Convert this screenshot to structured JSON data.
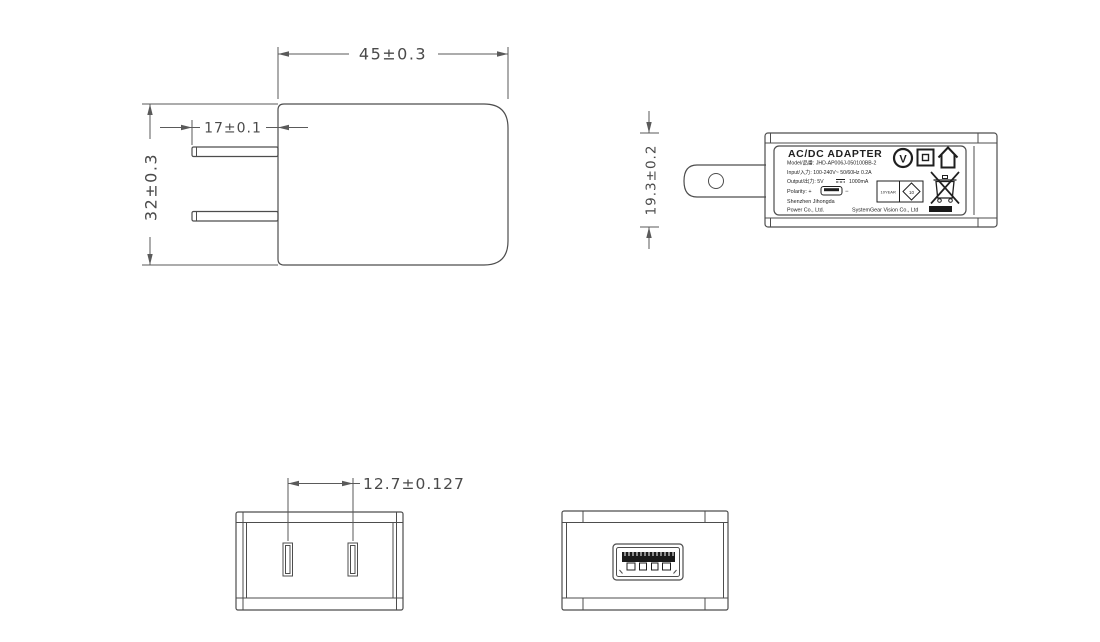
{
  "drawing_title": "AC/DC adapter engineering drawing",
  "colors": {
    "background": "#ffffff",
    "line": "#4d4d4d",
    "dim_text": "#4a4a4a",
    "label_text": "#1f1f1f"
  },
  "views": {
    "front": {
      "dim_width": "45±0.3",
      "dim_pin_length": "17±0.1",
      "dim_height": "32±0.3"
    },
    "side": {
      "dim_thickness": "19.3±0.2"
    },
    "top": {
      "dim_pin_pitch": "12.7±0.127"
    },
    "bottom": {}
  },
  "label": {
    "title": "AC/DC  ADAPTER",
    "model": "Model/品番: JHD-AP006J-050100BB-2",
    "input": "Input/入力: 100-240V~ 50/60Hz 0.2A",
    "output_prefix": "Output/出力: 5V",
    "output_suffix": "1000mA",
    "polarity_prefix": "Polarity: +",
    "polarity_suffix": "−",
    "company1": "Shenzhen Jihongda",
    "company2": "Power Co., Ltd.",
    "company3": "SystemGear Vision Co., Ltd",
    "efup_box": "10YEAR",
    "efup_diamond": "10",
    "v_mark": "V",
    "icons": [
      "v-certification-icon",
      "class-ii-icon",
      "indoor-use-icon",
      "efup-diamond-icon",
      "weee-bin-icon",
      "usb-plug-icon",
      "dc-symbol-icon"
    ]
  }
}
